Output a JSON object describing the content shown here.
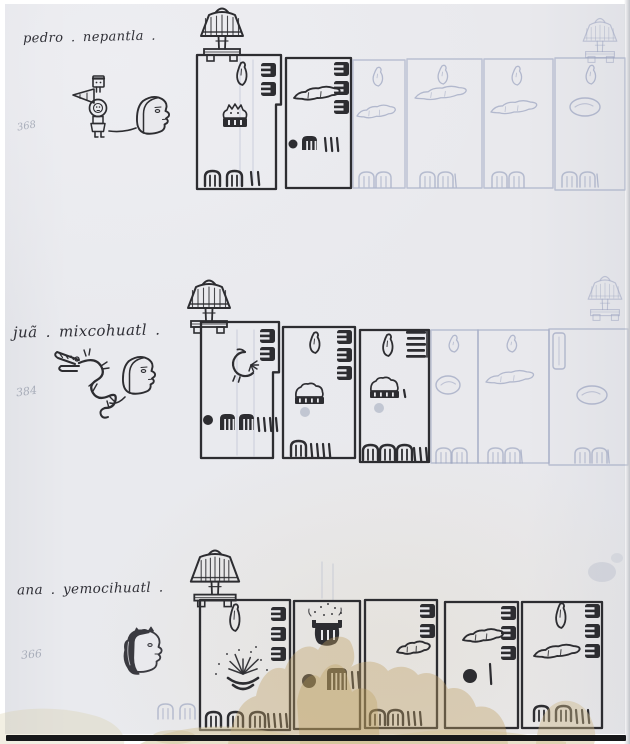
{
  "document_type": "pictorial manuscript census page",
  "palette": {
    "paper": "#e9e9ed",
    "ink": "#2d2d31",
    "ink_soft": "#3a3a40",
    "faint": "#9aa3bf",
    "pencil": "#9aa3b8",
    "stain": "#c1a163",
    "stain_light": "#d4c498",
    "photo_edge": "#17181a"
  },
  "glyph_legend": {
    "droplet": "seed-droplet glyph",
    "enotch": "notched-block glyph",
    "ladder": "bar-stack glyph",
    "caterpillar": "worm glyph",
    "critter": "spiky-animal-on-base glyph",
    "mound": "animal-on-base glyph",
    "bird": "bird glyph",
    "burst": "plant-burst glyph",
    "pot": "vessel-with-sprinkles glyph",
    "blob": "round outline glyph",
    "rect": "bar outline glyph",
    "arch": "maize-arch glyph",
    "comb": "comb-count glyph",
    "tick": "unit tick",
    "dot": "dot marker",
    "dotf": "faint dot smudge"
  },
  "registers": [
    {
      "caption": "pedro . nepantla .",
      "margin_number": "368",
      "figures": [
        {
          "type": "flag-person",
          "x": 86,
          "y": 76
        },
        {
          "type": "man-head",
          "x": 134,
          "y": 96
        }
      ],
      "link_line": {
        "x1": 109,
        "y1": 131,
        "x2": 136,
        "y2": 128
      },
      "trees": [
        {
          "x": 222,
          "y": 12,
          "faint": false,
          "big": false
        },
        {
          "x": 600,
          "y": 22,
          "faint": true,
          "big": false
        }
      ],
      "parcels": [
        {
          "x": 197,
          "y": 55,
          "w": 84,
          "h": 134,
          "faint": false,
          "step": {
            "at": 0.37,
            "dx": 5
          },
          "glyphs": [
            {
              "t": "droplet",
              "x": 236,
              "y": 63,
              "s": 22
            },
            {
              "t": "enotch",
              "x": 261,
              "y": 63
            },
            {
              "t": "enotch",
              "x": 261,
              "y": 82
            },
            {
              "t": "critter",
              "x": 222,
              "y": 102
            },
            {
              "t": "arch",
              "x": 205,
              "y": 171
            },
            {
              "t": "arch",
              "x": 227,
              "y": 171
            },
            {
              "t": "tick",
              "x": 251,
              "y": 172
            },
            {
              "t": "tick",
              "x": 258,
              "y": 172
            }
          ]
        },
        {
          "x": 286,
          "y": 58,
          "w": 65,
          "h": 130,
          "faint": false,
          "glyphs": [
            {
              "t": "enotch",
              "x": 334,
              "y": 62
            },
            {
              "t": "enotch",
              "x": 334,
              "y": 81
            },
            {
              "t": "enotch",
              "x": 334,
              "y": 100
            },
            {
              "t": "caterpillar",
              "x": 294,
              "y": 98,
              "w": 50
            },
            {
              "t": "dot",
              "x": 293,
              "y": 144,
              "r": 4.5
            },
            {
              "t": "comb",
              "x": 302,
              "y": 136
            },
            {
              "t": "tick",
              "x": 325,
              "y": 138
            },
            {
              "t": "tick",
              "x": 331,
              "y": 138
            },
            {
              "t": "tick",
              "x": 337,
              "y": 138
            }
          ]
        },
        {
          "x": 353,
          "y": 60,
          "w": 52,
          "h": 128,
          "faint": true,
          "glyphs": [
            {
              "t": "droplet",
              "x": 372,
              "y": 68,
              "s": 18
            },
            {
              "t": "caterpillar",
              "x": 357,
              "y": 116,
              "w": 42
            },
            {
              "t": "arch",
              "x": 359,
              "y": 172
            },
            {
              "t": "arch",
              "x": 376,
              "y": 172
            }
          ]
        },
        {
          "x": 407,
          "y": 59,
          "w": 75,
          "h": 129,
          "faint": true,
          "glyphs": [
            {
              "t": "droplet",
              "x": 437,
              "y": 66,
              "s": 18
            },
            {
              "t": "caterpillar",
              "x": 415,
              "y": 98,
              "w": 56
            },
            {
              "t": "arch",
              "x": 420,
              "y": 172
            },
            {
              "t": "arch",
              "x": 438,
              "y": 172
            },
            {
              "t": "tick",
              "x": 455,
              "y": 174
            }
          ]
        },
        {
          "x": 484,
          "y": 59,
          "w": 69,
          "h": 129,
          "faint": true,
          "glyphs": [
            {
              "t": "droplet",
              "x": 511,
              "y": 67,
              "s": 18
            },
            {
              "t": "caterpillar",
              "x": 491,
              "y": 112,
              "w": 50
            },
            {
              "t": "arch",
              "x": 492,
              "y": 172
            },
            {
              "t": "arch",
              "x": 509,
              "y": 172
            }
          ]
        },
        {
          "x": 555,
          "y": 58,
          "w": 70,
          "h": 132,
          "faint": true,
          "glyphs": [
            {
              "t": "droplet",
              "x": 585,
              "y": 66,
              "s": 18
            },
            {
              "t": "blob",
              "x": 570,
              "y": 98,
              "w": 30
            },
            {
              "t": "arch",
              "x": 562,
              "y": 172
            },
            {
              "t": "arch",
              "x": 580,
              "y": 172
            },
            {
              "t": "tick",
              "x": 597,
              "y": 174
            }
          ]
        }
      ]
    },
    {
      "caption": "juã . mixcohuatl .",
      "margin_number": "384",
      "figures": [
        {
          "type": "serpent",
          "x": 55,
          "y": 350
        },
        {
          "type": "man-head",
          "x": 120,
          "y": 356
        }
      ],
      "link_line": {
        "x1": 110,
        "y1": 403,
        "x2": 125,
        "y2": 397
      },
      "trees": [
        {
          "x": 209,
          "y": 284,
          "faint": false,
          "big": false
        },
        {
          "x": 605,
          "y": 280,
          "faint": true,
          "big": false
        }
      ],
      "parcels": [
        {
          "x": 201,
          "y": 322,
          "w": 78,
          "h": 136,
          "faint": false,
          "step": {
            "at": 0.37,
            "dx": 6
          },
          "glyphs": [
            {
              "t": "enotch",
              "x": 260,
              "y": 329
            },
            {
              "t": "enotch",
              "x": 260,
              "y": 347
            },
            {
              "t": "bird",
              "x": 225,
              "y": 352
            },
            {
              "t": "dot",
              "x": 208,
              "y": 420,
              "r": 5
            },
            {
              "t": "comb",
              "x": 220,
              "y": 414,
              "h": 16
            },
            {
              "t": "comb",
              "x": 239,
              "y": 414,
              "h": 16
            },
            {
              "t": "tick",
              "x": 258,
              "y": 418
            },
            {
              "t": "tick",
              "x": 264,
              "y": 418
            },
            {
              "t": "tick",
              "x": 270,
              "y": 418
            },
            {
              "t": "tick",
              "x": 276,
              "y": 418
            }
          ]
        },
        {
          "x": 283,
          "y": 327,
          "w": 72,
          "h": 131,
          "faint": false,
          "glyphs": [
            {
              "t": "droplet",
              "x": 309,
              "y": 333,
              "s": 20
            },
            {
              "t": "enotch",
              "x": 337,
              "y": 330
            },
            {
              "t": "enotch",
              "x": 337,
              "y": 348
            },
            {
              "t": "enotch",
              "x": 337,
              "y": 366
            },
            {
              "t": "mound",
              "x": 296,
              "y": 384
            },
            {
              "t": "dotf",
              "x": 305,
              "y": 412,
              "r": 5
            },
            {
              "t": "arch",
              "x": 291,
              "y": 441
            },
            {
              "t": "tick",
              "x": 311,
              "y": 444
            },
            {
              "t": "tick",
              "x": 317,
              "y": 444
            },
            {
              "t": "tick",
              "x": 323,
              "y": 444
            },
            {
              "t": "tick",
              "x": 329,
              "y": 444
            }
          ]
        },
        {
          "x": 360,
          "y": 330,
          "w": 69,
          "h": 132,
          "faint": false,
          "glyphs": [
            {
              "t": "droplet",
              "x": 382,
              "y": 335,
              "s": 21
            },
            {
              "t": "ladder",
              "x": 406,
              "y": 331
            },
            {
              "t": "mound",
              "x": 371,
              "y": 378
            },
            {
              "t": "dotf",
              "x": 379,
              "y": 408,
              "r": 5
            },
            {
              "t": "tick",
              "x": 404,
              "y": 390,
              "h": 7
            },
            {
              "t": "arch",
              "x": 363,
              "y": 445
            },
            {
              "t": "arch",
              "x": 380,
              "y": 445
            },
            {
              "t": "arch",
              "x": 397,
              "y": 445
            },
            {
              "t": "tick",
              "x": 414,
              "y": 448
            },
            {
              "t": "tick",
              "x": 420,
              "y": 448
            },
            {
              "t": "tick",
              "x": 426,
              "y": 448
            }
          ]
        },
        {
          "x": 431,
          "y": 330,
          "w": 47,
          "h": 133,
          "faint": true,
          "glyphs": [
            {
              "t": "droplet",
              "x": 448,
              "y": 336,
              "s": 16
            },
            {
              "t": "blob",
              "x": 436,
              "y": 376,
              "w": 24
            },
            {
              "t": "arch",
              "x": 436,
              "y": 448
            },
            {
              "t": "arch",
              "x": 452,
              "y": 448
            }
          ]
        },
        {
          "x": 478,
          "y": 330,
          "w": 71,
          "h": 133,
          "faint": true,
          "glyphs": [
            {
              "t": "droplet",
              "x": 506,
              "y": 336,
              "s": 16
            },
            {
              "t": "caterpillar",
              "x": 486,
              "y": 382,
              "w": 52
            },
            {
              "t": "arch",
              "x": 488,
              "y": 448
            },
            {
              "t": "arch",
              "x": 505,
              "y": 448
            },
            {
              "t": "tick",
              "x": 521,
              "y": 450
            }
          ]
        },
        {
          "x": 549,
          "y": 329,
          "w": 79,
          "h": 136,
          "faint": true,
          "glyphs": [
            {
              "t": "rect",
              "x": 553,
              "y": 333
            },
            {
              "t": "blob",
              "x": 577,
              "y": 386,
              "w": 30
            },
            {
              "t": "arch",
              "x": 575,
              "y": 448
            },
            {
              "t": "arch",
              "x": 592,
              "y": 448
            },
            {
              "t": "tick",
              "x": 608,
              "y": 450
            }
          ]
        }
      ]
    },
    {
      "caption": "ana . yemocihuatl .",
      "margin_number": "366",
      "figures": [
        {
          "type": "woman-head",
          "x": 122,
          "y": 628
        }
      ],
      "trees": [
        {
          "x": 215,
          "y": 554,
          "faint": false,
          "big": true
        }
      ],
      "loose_glyphs": [
        {
          "t": "archf",
          "x": 158,
          "y": 704
        },
        {
          "t": "archf",
          "x": 180,
          "y": 704
        }
      ],
      "parcels": [
        {
          "x": 200,
          "y": 600,
          "w": 90,
          "h": 130,
          "faint": false,
          "glyphs": [
            {
              "t": "droplet",
              "x": 229,
              "y": 605,
              "s": 26
            },
            {
              "t": "enotch",
              "x": 271,
              "y": 607
            },
            {
              "t": "enotch",
              "x": 271,
              "y": 627
            },
            {
              "t": "enotch",
              "x": 271,
              "y": 647
            },
            {
              "t": "burst",
              "x": 243,
              "y": 676
            },
            {
              "t": "arch",
              "x": 206,
              "y": 712
            },
            {
              "t": "arch",
              "x": 228,
              "y": 712
            },
            {
              "t": "arch",
              "x": 250,
              "y": 712
            },
            {
              "t": "tick",
              "x": 268,
              "y": 714
            },
            {
              "t": "tick",
              "x": 274,
              "y": 714
            },
            {
              "t": "tick",
              "x": 280,
              "y": 714
            },
            {
              "t": "tick",
              "x": 286,
              "y": 714
            }
          ]
        },
        {
          "x": 294,
          "y": 601,
          "w": 66,
          "h": 128,
          "faint": false,
          "glyphs": [
            {
              "t": "pot",
              "x": 313,
              "y": 620
            },
            {
              "t": "dot",
              "x": 309,
              "y": 681,
              "r": 7
            },
            {
              "t": "comb",
              "x": 327,
              "y": 668,
              "w": 20,
              "h": 22
            },
            {
              "t": "tick",
              "x": 352,
              "y": 672,
              "h": 16
            },
            {
              "t": "tick",
              "x": 358,
              "y": 672,
              "h": 16
            }
          ]
        },
        {
          "x": 365,
          "y": 600,
          "w": 72,
          "h": 128,
          "faint": false,
          "glyphs": [
            {
              "t": "enotch",
              "x": 420,
              "y": 604
            },
            {
              "t": "enotch",
              "x": 420,
              "y": 624
            },
            {
              "t": "caterpillar",
              "x": 397,
              "y": 652,
              "w": 36
            },
            {
              "t": "arch",
              "x": 370,
              "y": 710
            },
            {
              "t": "arch",
              "x": 388,
              "y": 710
            },
            {
              "t": "tick",
              "x": 408,
              "y": 712
            },
            {
              "t": "tick",
              "x": 414,
              "y": 712
            },
            {
              "t": "tick",
              "x": 420,
              "y": 712
            }
          ]
        },
        {
          "x": 445,
          "y": 602,
          "w": 73,
          "h": 126,
          "faint": false,
          "glyphs": [
            {
              "t": "enotch",
              "x": 501,
              "y": 606
            },
            {
              "t": "enotch",
              "x": 501,
              "y": 626
            },
            {
              "t": "enotch",
              "x": 501,
              "y": 646
            },
            {
              "t": "caterpillar",
              "x": 463,
              "y": 640,
              "w": 44
            },
            {
              "t": "dot",
              "x": 470,
              "y": 676,
              "r": 7
            },
            {
              "t": "tick",
              "x": 490,
              "y": 664,
              "h": 20
            }
          ]
        },
        {
          "x": 522,
          "y": 602,
          "w": 80,
          "h": 126,
          "faint": false,
          "glyphs": [
            {
              "t": "droplet",
              "x": 555,
              "y": 604,
              "s": 24
            },
            {
              "t": "enotch",
              "x": 585,
              "y": 604
            },
            {
              "t": "enotch",
              "x": 585,
              "y": 624
            },
            {
              "t": "enotch",
              "x": 585,
              "y": 644
            },
            {
              "t": "caterpillar",
              "x": 534,
              "y": 656,
              "w": 50
            },
            {
              "t": "arch",
              "x": 534,
              "y": 706
            },
            {
              "t": "arch",
              "x": 556,
              "y": 706
            },
            {
              "t": "tick",
              "x": 576,
              "y": 710
            },
            {
              "t": "tick",
              "x": 582,
              "y": 710
            },
            {
              "t": "tick",
              "x": 588,
              "y": 710
            }
          ]
        }
      ]
    }
  ]
}
